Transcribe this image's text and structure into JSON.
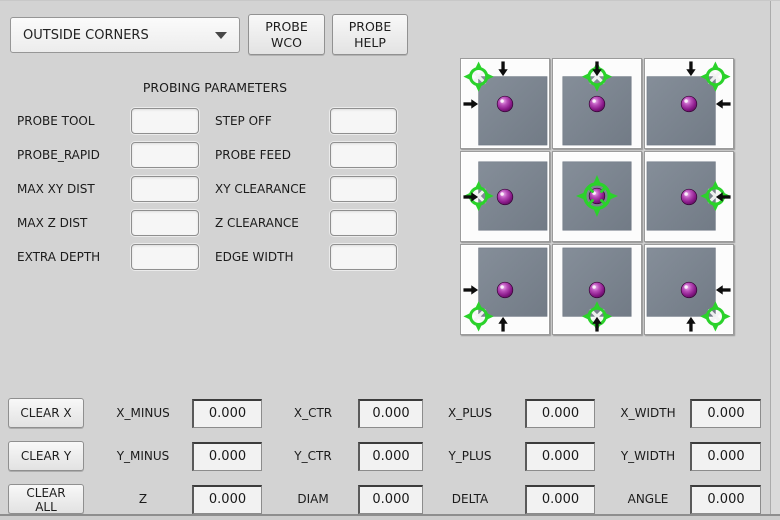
{
  "colors": {
    "background": "#d3d3d3",
    "accent_green": "#2bd22b",
    "sphere_purple": "#8a1a8a",
    "square_gray": "#7c8591",
    "arrow_black": "#0d0d0d"
  },
  "toolbar": {
    "mode_select": {
      "value": "OUTSIDE CORNERS",
      "icon": "chevron-down-icon"
    },
    "probe_wco": {
      "line1": "PROBE",
      "line2": "WCO"
    },
    "probe_help": {
      "line1": "PROBE",
      "line2": "HELP"
    }
  },
  "parameters": {
    "title": "PROBING PARAMETERS",
    "rows": [
      {
        "left_label": "PROBE TOOL",
        "left_value": "",
        "right_label": "STEP OFF",
        "right_value": ""
      },
      {
        "left_label": "PROBE_RAPID",
        "left_value": "",
        "right_label": "PROBE FEED",
        "right_value": ""
      },
      {
        "left_label": "MAX XY DIST",
        "left_value": "",
        "right_label": "XY CLEARANCE",
        "right_value": ""
      },
      {
        "left_label": "MAX Z DIST",
        "left_value": "",
        "right_label": "Z CLEARANCE",
        "right_value": ""
      },
      {
        "left_label": "EXTRA DEPTH",
        "left_value": "",
        "right_label": "EDGE WIDTH",
        "right_value": ""
      }
    ]
  },
  "probe_grid": {
    "cells": [
      {
        "name": "corner-top-left",
        "probe": "tl",
        "arrows": [
          "down",
          "right"
        ]
      },
      {
        "name": "edge-top",
        "probe": "t",
        "arrows": [
          "down"
        ]
      },
      {
        "name": "corner-top-right",
        "probe": "tr",
        "arrows": [
          "down",
          "left"
        ]
      },
      {
        "name": "edge-left",
        "probe": "l",
        "arrows": [
          "right"
        ]
      },
      {
        "name": "center",
        "probe": "c",
        "arrows": []
      },
      {
        "name": "edge-right",
        "probe": "r",
        "arrows": [
          "left"
        ]
      },
      {
        "name": "corner-bottom-left",
        "probe": "bl",
        "arrows": [
          "up",
          "right"
        ]
      },
      {
        "name": "edge-bottom",
        "probe": "b",
        "arrows": [
          "up"
        ]
      },
      {
        "name": "corner-bottom-right",
        "probe": "br",
        "arrows": [
          "up",
          "left"
        ]
      }
    ]
  },
  "results": {
    "buttons": [
      {
        "label": "CLEAR X"
      },
      {
        "label": "CLEAR Y"
      },
      {
        "label": "CLEAR ALL"
      }
    ],
    "rows": [
      {
        "cells": [
          {
            "label": "X_MINUS",
            "value": "0.000"
          },
          {
            "label": "X_CTR",
            "value": "0.000"
          },
          {
            "label": "X_PLUS",
            "value": "0.000"
          },
          {
            "label": "X_WIDTH",
            "value": "0.000"
          }
        ]
      },
      {
        "cells": [
          {
            "label": "Y_MINUS",
            "value": "0.000"
          },
          {
            "label": "Y_CTR",
            "value": "0.000"
          },
          {
            "label": "Y_PLUS",
            "value": "0.000"
          },
          {
            "label": "Y_WIDTH",
            "value": "0.000"
          }
        ]
      },
      {
        "cells": [
          {
            "label": "Z",
            "value": "0.000"
          },
          {
            "label": "DIAM",
            "value": "0.000"
          },
          {
            "label": "DELTA",
            "value": "0.000"
          },
          {
            "label": "ANGLE",
            "value": "0.000"
          }
        ]
      }
    ]
  }
}
